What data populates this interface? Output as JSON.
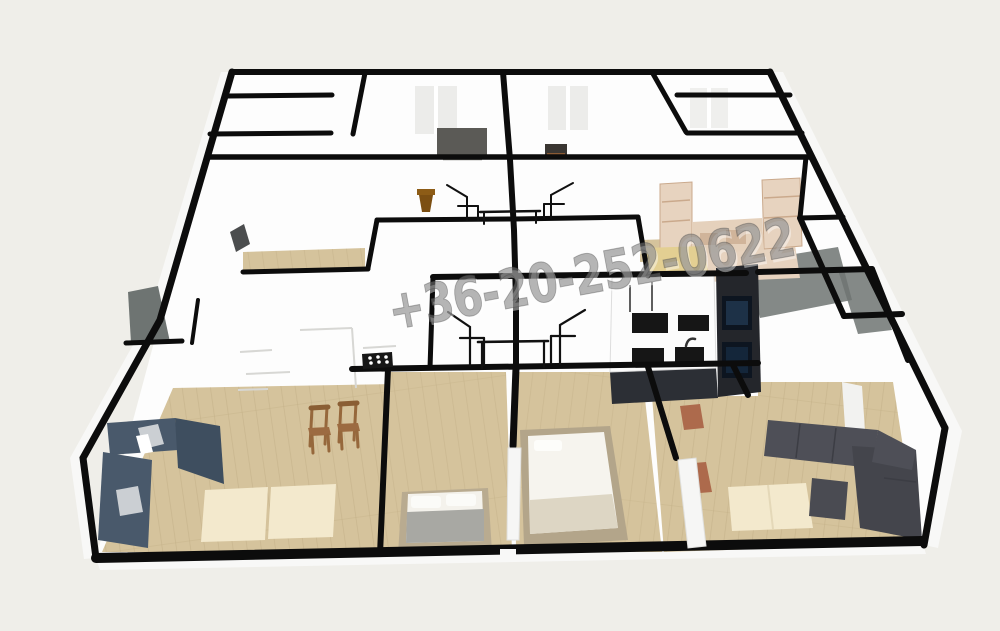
{
  "watermark": {
    "text": "+36-20-252-0622"
  },
  "palette": {
    "background": "#efeee9",
    "floor": "#fdfdfd",
    "wall": "#0c0c0c",
    "wallFace": "#f8f8f7",
    "wood": "#d5c39c",
    "woodLine": "#b4a077",
    "rug": "#f3e9cd",
    "navy": "#49596b",
    "navyDark": "#3e4e5f",
    "pillow": "#cbcfd3",
    "charcoal": "#4e4f57",
    "charcoalDark": "#44454c",
    "chairWood": "#9c6b41",
    "terracotta": "#ad6a4c",
    "kitchenDark": "#24262b",
    "kitchenFace": "#2c2f35",
    "applianceOuter": "#0d1520",
    "applianceInner": "#1d3147",
    "itemBlack": "#161616",
    "wardrobe": "#e7d3bf",
    "wardrobeLine": "#c8a88b",
    "bench": "#e3cf92",
    "pot": "#7c4f12",
    "tv": "#5b5a56",
    "shadow": "#6e7472",
    "grayItem": "#4b4d4e",
    "white": "#ffffff",
    "watermarkFill": "rgba(120,120,120,0.55)",
    "watermarkEdge": "rgba(70,70,70,0.38)",
    "watermarkHi": "rgba(255,255,255,0.42)"
  }
}
